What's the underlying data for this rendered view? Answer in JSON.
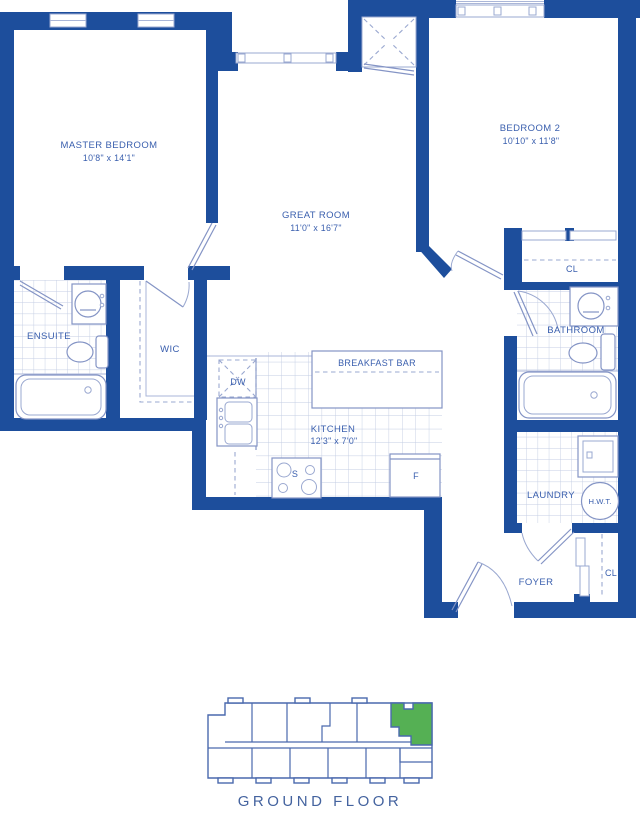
{
  "floor_label": "GROUND FLOOR",
  "colors": {
    "wall_blue": "#1d4e9c",
    "fixture_blue": "#8494c5",
    "text_blue": "#3a5fae",
    "tile_blue": "#c3cde3",
    "highlight_green": "#55b054"
  },
  "rooms": {
    "master": {
      "name": "MASTER BEDROOM",
      "dims": "10'8\" x 14'1\""
    },
    "great": {
      "name": "GREAT ROOM",
      "dims": "11'0\" x 16'7\""
    },
    "bedroom2": {
      "name": "BEDROOM 2",
      "dims": "10'10\" x 11'8\""
    },
    "kitchen": {
      "name": "KITCHEN",
      "dims": "12'3\" x 7'0\""
    },
    "breakfast_bar": {
      "name": "BREAKFAST BAR"
    },
    "ensuite": {
      "name": "ENSUITE"
    },
    "wic": {
      "name": "WIC"
    },
    "bathroom": {
      "name": "BATHROOM"
    },
    "laundry": {
      "name": "LAUNDRY"
    },
    "foyer": {
      "name": "FOYER"
    },
    "closet_bedroom2": {
      "name": "CL"
    },
    "closet_foyer": {
      "name": "CL"
    }
  },
  "labels": {
    "dishwasher": "DW",
    "stove": "S",
    "fridge": "F",
    "hot_water_tank": "H.W.T."
  }
}
